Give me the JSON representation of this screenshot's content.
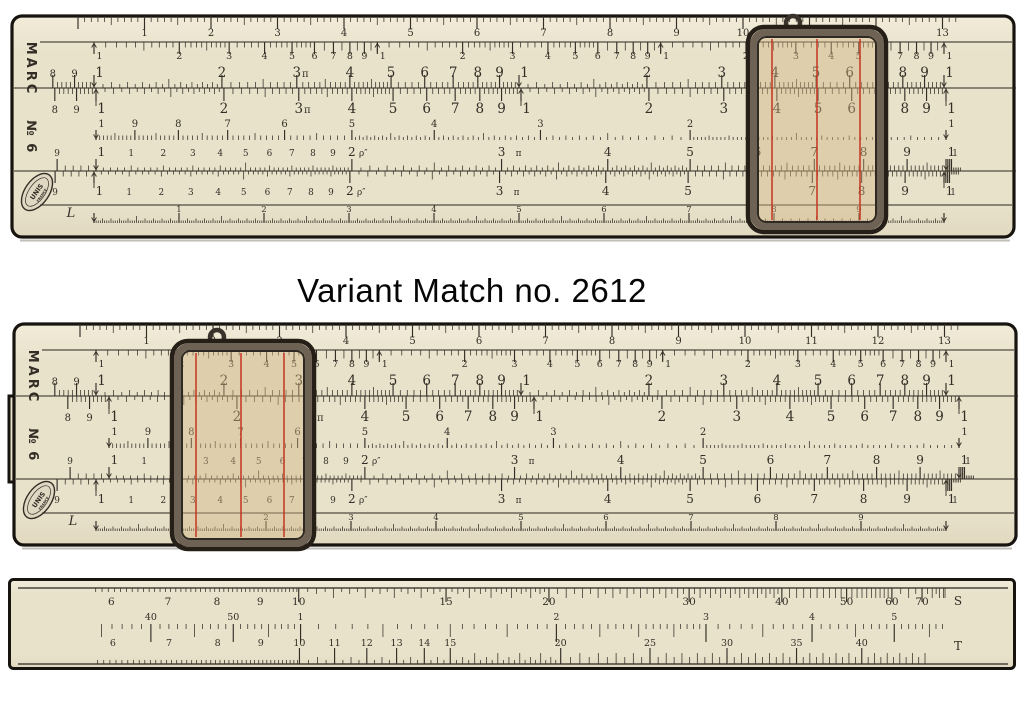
{
  "caption": "Variant Match no. 2612",
  "colors": {
    "background": "#ffffff",
    "body": "#e9e2cb",
    "body_light": "#f1ebd9",
    "body_dark": "#e0d8bf",
    "edge": "#17130e",
    "ink": "#332d26",
    "seam": "#2a251f",
    "hairline": "#c7311f",
    "glass": "#d2b684",
    "frame_dark": "#261f18",
    "frame_mid": "#6e6254",
    "caption_ink": "#060606"
  },
  "rule": {
    "brand": "MARC",
    "model": "№ 6",
    "logo": {
      "line1": "UNIS",
      "line2": "FRANCE"
    },
    "l_letter": "L",
    "scales": {
      "ruler": {
        "name": "ruler-cm",
        "labels": [
          "1",
          "2",
          "3",
          "4",
          "5",
          "6",
          "7",
          "8",
          "9",
          "10",
          "11",
          "12",
          "13"
        ]
      },
      "K": {
        "name": "K-cubes",
        "labels": [
          {
            "v": 1,
            "t": "1",
            "a": 1
          },
          {
            "v": 2,
            "t": "2"
          },
          {
            "v": 3,
            "t": "3"
          },
          {
            "v": 4,
            "t": "4"
          },
          {
            "v": 5,
            "t": "5"
          },
          {
            "v": 6,
            "t": "6"
          },
          {
            "v": 7,
            "t": "7"
          },
          {
            "v": 8,
            "t": "8"
          },
          {
            "v": 9,
            "t": "9"
          },
          {
            "v": 10,
            "t": "1",
            "a": 1
          },
          {
            "v": 20,
            "t": "2"
          },
          {
            "v": 30,
            "t": "3"
          },
          {
            "v": 40,
            "t": "4"
          },
          {
            "v": 50,
            "t": "5"
          },
          {
            "v": 60,
            "t": "6"
          },
          {
            "v": 70,
            "t": "7"
          },
          {
            "v": 80,
            "t": "8"
          },
          {
            "v": 90,
            "t": "9"
          },
          {
            "v": 100,
            "t": "1",
            "a": 1
          },
          {
            "v": 200,
            "t": "2"
          },
          {
            "v": 300,
            "t": "3"
          },
          {
            "v": 400,
            "t": "4"
          },
          {
            "v": 500,
            "t": "5"
          },
          {
            "v": 600,
            "t": "6"
          },
          {
            "v": 700,
            "t": "7"
          },
          {
            "v": 800,
            "t": "8"
          },
          {
            "v": 900,
            "t": "9"
          },
          {
            "v": 1000,
            "t": "1",
            "a": 1
          }
        ]
      },
      "AB": {
        "name": "A-B-squares",
        "labels": [
          {
            "v": 0.8,
            "t": "8",
            "s": 1
          },
          {
            "v": 0.9,
            "t": "9",
            "s": 1
          },
          {
            "v": 1,
            "t": "1",
            "a": 1
          },
          {
            "v": 2,
            "t": "2"
          },
          {
            "v": 3,
            "t": "3"
          },
          {
            "v": 3.1416,
            "t": "π",
            "s": 1
          },
          {
            "v": 4,
            "t": "4"
          },
          {
            "v": 5,
            "t": "5"
          },
          {
            "v": 6,
            "t": "6"
          },
          {
            "v": 7,
            "t": "7"
          },
          {
            "v": 8,
            "t": "8"
          },
          {
            "v": 9,
            "t": "9"
          },
          {
            "v": 10,
            "t": "1",
            "a": 1
          },
          {
            "v": 20,
            "t": "2"
          },
          {
            "v": 30,
            "t": "3"
          },
          {
            "v": 40,
            "t": "4"
          },
          {
            "v": 50,
            "t": "5"
          },
          {
            "v": 60,
            "t": "6"
          },
          {
            "v": 70,
            "t": "7"
          },
          {
            "v": 80,
            "t": "8"
          },
          {
            "v": 90,
            "t": "9"
          },
          {
            "v": 100,
            "t": "1",
            "a": 1
          }
        ]
      },
      "CI": {
        "name": "CI-inverted",
        "labels": [
          {
            "v": 10,
            "t": "1",
            "a": 1
          },
          {
            "v": 9,
            "t": "9"
          },
          {
            "v": 8,
            "t": "8"
          },
          {
            "v": 7,
            "t": "7"
          },
          {
            "v": 6,
            "t": "6"
          },
          {
            "v": 5,
            "t": "5"
          },
          {
            "v": 4,
            "t": "4"
          },
          {
            "v": 3,
            "t": "3"
          },
          {
            "v": 2,
            "t": "2"
          },
          {
            "v": 1,
            "t": "1",
            "a": 1
          }
        ]
      },
      "CD": {
        "name": "C-D",
        "labels": [
          {
            "v": 0.9,
            "t": "9",
            "s": 1
          },
          {
            "v": 1,
            "t": "1",
            "a": 1
          },
          {
            "v": 1.1,
            "t": "1",
            "s": 1
          },
          {
            "v": 1.2,
            "t": "2",
            "s": 1
          },
          {
            "v": 1.3,
            "t": "3",
            "s": 1
          },
          {
            "v": 1.4,
            "t": "4",
            "s": 1
          },
          {
            "v": 1.5,
            "t": "5",
            "s": 1
          },
          {
            "v": 1.6,
            "t": "6",
            "s": 1
          },
          {
            "v": 1.7,
            "t": "7",
            "s": 1
          },
          {
            "v": 1.8,
            "t": "8",
            "s": 1
          },
          {
            "v": 1.9,
            "t": "9",
            "s": 1
          },
          {
            "v": 2,
            "t": "2"
          },
          {
            "v": 2.0627,
            "t": "ρ″",
            "s": 1
          },
          {
            "v": 3,
            "t": "3"
          },
          {
            "v": 3.1416,
            "t": "π",
            "s": 1
          },
          {
            "v": 4,
            "t": "4"
          },
          {
            "v": 5,
            "t": "5"
          },
          {
            "v": 6,
            "t": "6"
          },
          {
            "v": 7,
            "t": "7"
          },
          {
            "v": 8,
            "t": "8"
          },
          {
            "v": 9,
            "t": "9"
          },
          {
            "v": 10,
            "t": "1",
            "a": 1
          },
          {
            "v": 10.25,
            "t": "1",
            "s": 1
          }
        ]
      },
      "L": {
        "name": "L-linear",
        "labels": [
          "1",
          "2",
          "3",
          "4",
          "5",
          "6",
          "7",
          "8",
          "9"
        ]
      }
    }
  },
  "instances": [
    {
      "id": "rule1",
      "name": "slide-rule-top",
      "cursor_x": 738,
      "cursor_y": 13,
      "cursor_w": 138,
      "cursor_h": 205,
      "slide_offset": 2,
      "left_step": false
    },
    {
      "id": "rule2",
      "name": "slide-rule-middle",
      "cursor_x": 160,
      "cursor_y": 19,
      "cursor_w": 142,
      "cursor_h": 208,
      "slide_offset": 13,
      "left_step": true
    }
  ],
  "strip": {
    "name": "sine-tangent-rule",
    "S": {
      "letter": "S",
      "labels": [
        {
          "v": 6,
          "t": "6"
        },
        {
          "v": 7,
          "t": "7"
        },
        {
          "v": 8,
          "t": "8"
        },
        {
          "v": 9,
          "t": "9"
        },
        {
          "v": 10,
          "t": "10"
        },
        {
          "v": 15,
          "t": "15"
        },
        {
          "v": 20,
          "t": "20"
        },
        {
          "v": 30,
          "t": "30"
        },
        {
          "v": 40,
          "t": "40"
        },
        {
          "v": 50,
          "t": "50"
        },
        {
          "v": 60,
          "t": "60"
        },
        {
          "v": 70,
          "t": "70"
        }
      ]
    },
    "ST": {
      "labels": [
        {
          "v": 0.6667,
          "t": "40"
        },
        {
          "v": 0.8333,
          "t": "50"
        },
        {
          "v": 1,
          "t": "1"
        },
        {
          "v": 2,
          "t": "2"
        },
        {
          "v": 3,
          "t": "3"
        },
        {
          "v": 4,
          "t": "4"
        },
        {
          "v": 5,
          "t": "5"
        }
      ]
    },
    "T": {
      "letter": "T",
      "labels": [
        {
          "v": 6,
          "t": "6"
        },
        {
          "v": 7,
          "t": "7"
        },
        {
          "v": 8,
          "t": "8"
        },
        {
          "v": 9,
          "t": "9"
        },
        {
          "v": 10,
          "t": "10"
        },
        {
          "v": 11,
          "t": "11"
        },
        {
          "v": 12,
          "t": "12"
        },
        {
          "v": 13,
          "t": "13"
        },
        {
          "v": 14,
          "t": "14"
        },
        {
          "v": 15,
          "t": "15"
        },
        {
          "v": 20,
          "t": "20"
        },
        {
          "v": 25,
          "t": "25"
        },
        {
          "v": 30,
          "t": "30"
        },
        {
          "v": 35,
          "t": "35"
        },
        {
          "v": 40,
          "t": "40"
        }
      ]
    }
  }
}
